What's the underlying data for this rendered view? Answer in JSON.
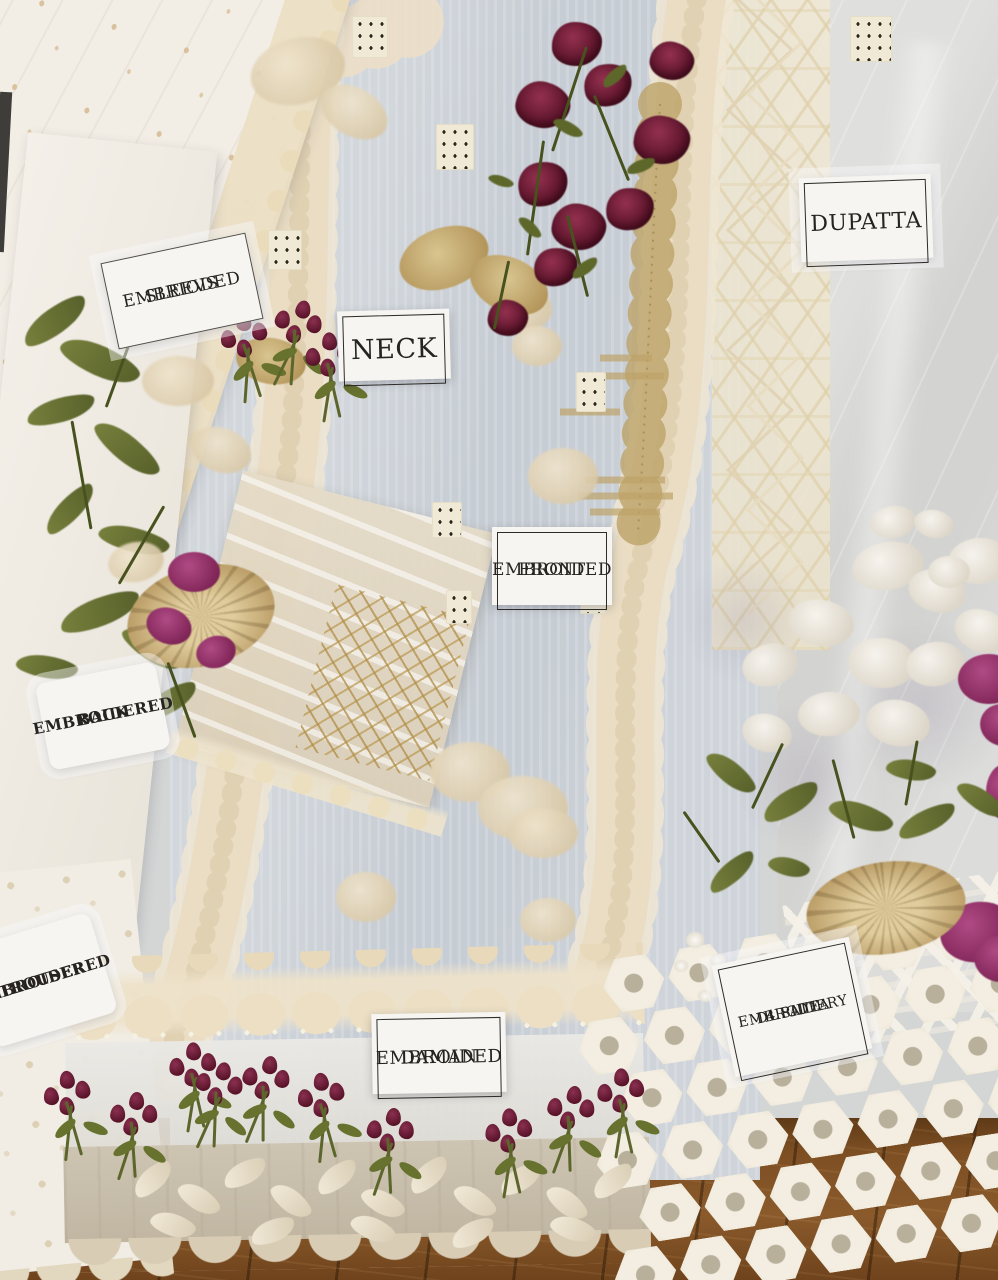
{
  "photo": {
    "subject": "Flat-lay product photo of an unstitched embroidered ladies suit fabric set with paper tags identifying each piece",
    "pieces": [
      "sleeves",
      "neck",
      "front",
      "back",
      "trouser",
      "daman",
      "dupatta"
    ],
    "surface": "wooden floor"
  },
  "tags": {
    "sleeves": {
      "line1": "EMBRIODED",
      "line2": "SLEEVS"
    },
    "neck": {
      "line1": "NECK"
    },
    "dupatta": {
      "line1": "DUPATTA"
    },
    "front": {
      "line1": "EMBROIDED",
      "line2": "FRONT"
    },
    "back": {
      "line1": "EMBROIDERED",
      "line2": "BACK"
    },
    "trouser": {
      "line1": "EMBROIDERED",
      "line2": "TROUSER"
    },
    "daman": {
      "line1": "EMBROIDED",
      "line2": "DAMAN"
    },
    "four_side": {
      "line1": "4 SIDE",
      "line2": "EMBROIDERY",
      "line3": "DUPATTA"
    }
  },
  "colors": {
    "fabric_grey_blue": "#c9ced6",
    "fabric_white": "#f2ede5",
    "lace_cream": "#e9ddc3",
    "gold_thread": "#bda268",
    "maroon_flower": "#6e1f38",
    "magenta_flower": "#9c3470",
    "olive_leaf": "#5f6b2c",
    "sheer_dupatta": "#d9d9d7",
    "wood_floor": "#7c4e22",
    "tag_paper": "#f6f5f1",
    "tag_text": "#262320"
  }
}
